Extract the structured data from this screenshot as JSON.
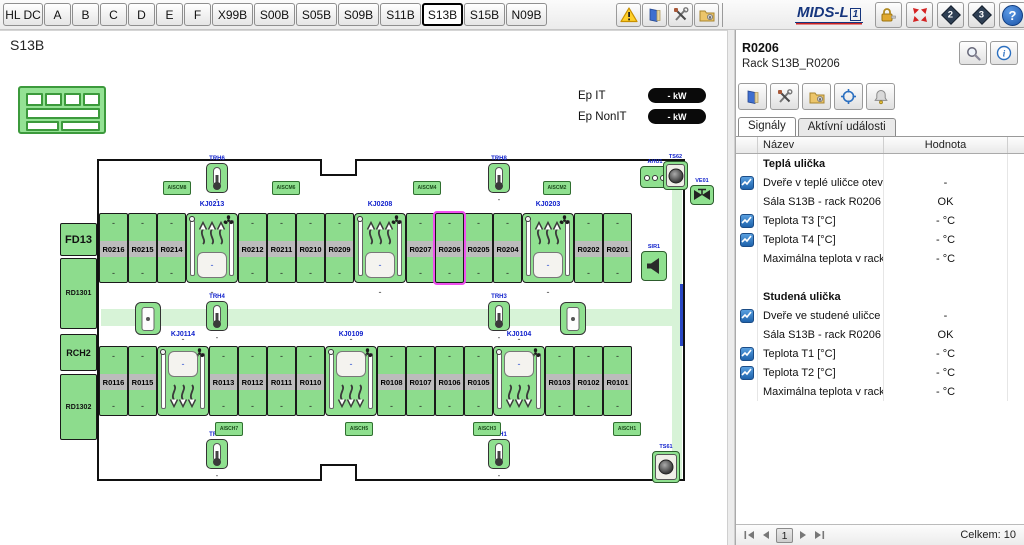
{
  "toolbar": {
    "tabs": [
      "HL DC",
      "A",
      "B",
      "C",
      "D",
      "E",
      "F",
      "X99B",
      "S00B",
      "S05B",
      "S09B",
      "S11B",
      "S13B",
      "S15B",
      "N09B"
    ],
    "selected_tab": "S13B",
    "logo_main": "MIDS-L",
    "logo_sup": "1",
    "diamond2": "2",
    "diamond3": "3",
    "help": "?",
    "icon_names": [
      "warning-icon",
      "exit-door-icon",
      "tools-icon",
      "folder-lock-icon",
      "lock-icon",
      "collapse-arrows-icon",
      "help-icon"
    ]
  },
  "map": {
    "title": "S13B",
    "ep": [
      {
        "label": "Ep IT",
        "value": "- kW"
      },
      {
        "label": "Ep NonIT",
        "value": "- kW"
      }
    ],
    "plan": {
      "selected_rack": "R0206",
      "placeholder": "-",
      "side_units": [
        "FD13",
        "RD1301",
        "RCH2",
        "RD1302"
      ],
      "top_row": [
        "R0216",
        "R0215",
        "R0214",
        "KJ0213",
        "R0212",
        "R0211",
        "R0210",
        "R0209",
        "KJ0208",
        "R0207",
        "R0206",
        "R0205",
        "R0204",
        "KJ0203",
        "R0202",
        "R0201"
      ],
      "bottom_row": [
        "R0116",
        "R0115",
        "KJ0114",
        "R0113",
        "R0112",
        "R0111",
        "R0110",
        "KJ0109",
        "R0108",
        "R0107",
        "R0106",
        "R0105",
        "KJ0104",
        "R0103",
        "R0102",
        "R0101"
      ],
      "thermometers": [
        "TRH6",
        "TRH8",
        "TRH4",
        "TRH3",
        "TRH2",
        "TRH1"
      ],
      "top_sensors": [
        "AISCM8",
        "AISCM6",
        "AISCM4",
        "AISCM2"
      ],
      "bottom_sensors": [
        "AISCH7",
        "AISCH5",
        "AISCH3",
        "AISCH1"
      ],
      "devices": {
        "ahu": "AHU1",
        "fan_top": "TS62",
        "valve": "VE01",
        "siren": "SIR1",
        "fan_bottom": "TS61"
      }
    }
  },
  "panel": {
    "title": "R0206",
    "subtitle": "Rack S13B_R0206",
    "tabs": [
      "Signály",
      "Aktívní události"
    ],
    "table": {
      "columns": [
        "Název",
        "Hodnota"
      ],
      "rows": [
        {
          "type": "group",
          "name": "Teplá ulička",
          "value": ""
        },
        {
          "type": "signal",
          "trend": true,
          "name": "Dveře v teplé uličce otevřené",
          "value": "-"
        },
        {
          "type": "signal",
          "trend": false,
          "name": "Sála S13B - rack R0206 - tepl",
          "value": "OK"
        },
        {
          "type": "signal",
          "trend": true,
          "name": "Teplota T3 [°C]",
          "value": "- °C"
        },
        {
          "type": "signal",
          "trend": true,
          "name": "Teplota T4 [°C]",
          "value": "- °C"
        },
        {
          "type": "signal",
          "trend": false,
          "name": "Maximálna teplota v racku R0",
          "value": "- °C"
        },
        {
          "type": "spacer",
          "name": "",
          "value": ""
        },
        {
          "type": "group",
          "name": "Studená ulička",
          "value": ""
        },
        {
          "type": "signal",
          "trend": true,
          "name": "Dveře ve studené uličce otevř",
          "value": "-"
        },
        {
          "type": "signal",
          "trend": false,
          "name": "Sála S13B - rack R0206 - stu",
          "value": "OK"
        },
        {
          "type": "signal",
          "trend": true,
          "name": "Teplota T1 [°C]",
          "value": "- °C"
        },
        {
          "type": "signal",
          "trend": true,
          "name": "Teplota T2 [°C]",
          "value": "- °C"
        },
        {
          "type": "signal",
          "trend": false,
          "name": "Maximálna teplota v racku R0",
          "value": "- °C"
        }
      ]
    },
    "footer": {
      "page": "1",
      "total": "Celkem: 10"
    }
  }
}
